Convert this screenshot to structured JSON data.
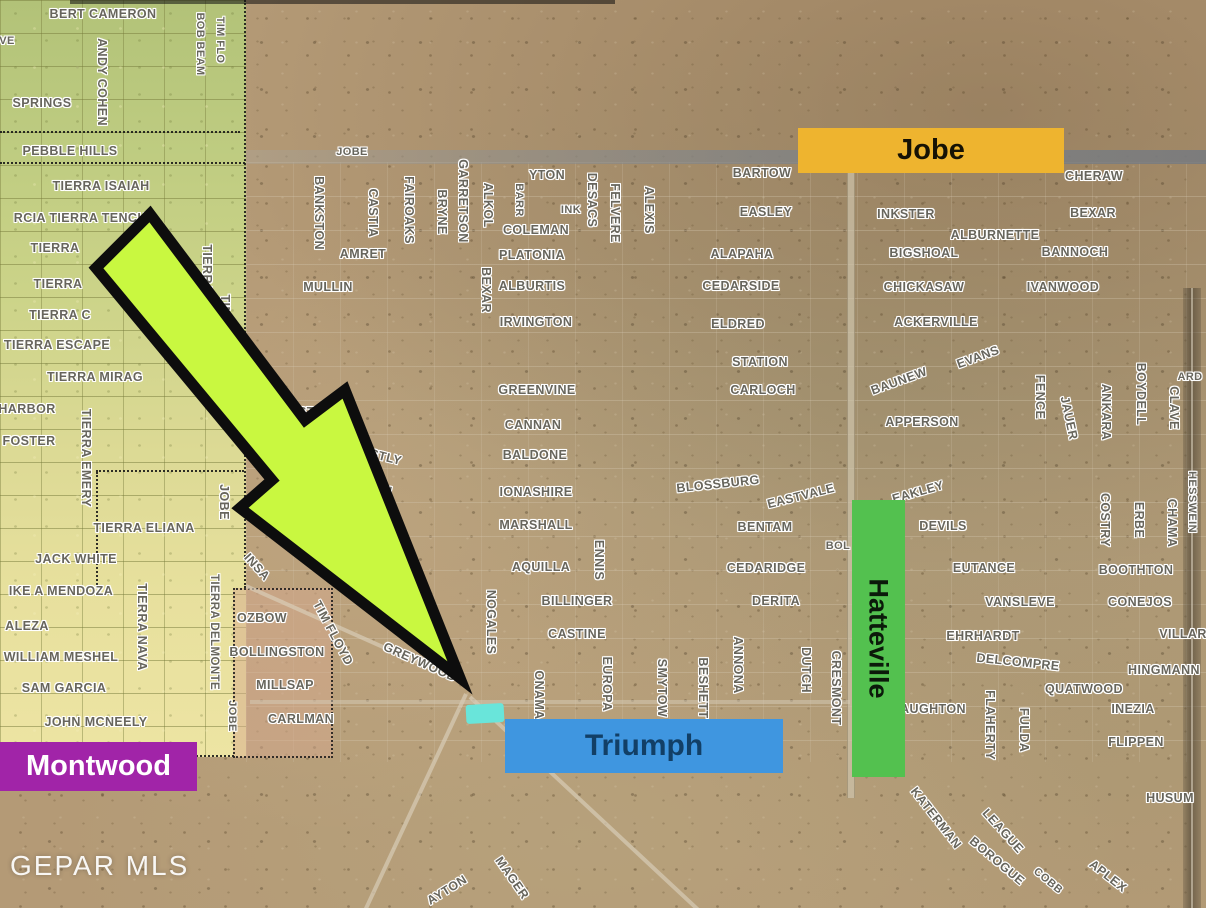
{
  "watermark": {
    "text": "GEPAR MLS"
  },
  "banners": {
    "jobe": {
      "label": "Jobe"
    },
    "triumph": {
      "label": "Triumph"
    },
    "hatteville": {
      "label": "Hatteville"
    },
    "montwood": {
      "label": "Montwood"
    }
  },
  "colors": {
    "jobe_banner": "#eeb42f",
    "triumph_banner": "#3f96e0",
    "hatteville_banner": "#53c14f",
    "montwood_banner": "#a124a8",
    "arrow_fill": "#c9f840",
    "highlight_lot": "#69e5da"
  },
  "street_labels": [
    {
      "t": "BERT CAMERON",
      "x": 103,
      "y": 14
    },
    {
      "t": "VE",
      "x": 7,
      "y": 41,
      "fs": 11
    },
    {
      "t": "ANDY COHEN",
      "x": 102,
      "y": 82,
      "r": 90
    },
    {
      "t": "BOB BEAM",
      "x": 200,
      "y": 44,
      "r": 90,
      "fs": 11
    },
    {
      "t": "TIM FLO",
      "x": 220,
      "y": 40,
      "r": 90,
      "fs": 11
    },
    {
      "t": "SPRINGS",
      "x": 42,
      "y": 103
    },
    {
      "t": "PEBBLE HILLS",
      "x": 70,
      "y": 151
    },
    {
      "t": "TIERRA ISAIAH",
      "x": 101,
      "y": 186
    },
    {
      "t": "RCIA TIERRA TENCHA",
      "x": 85,
      "y": 218
    },
    {
      "t": "TIERRA",
      "x": 55,
      "y": 248
    },
    {
      "t": "EN",
      "x": 148,
      "y": 249,
      "fs": 11
    },
    {
      "t": "TIERRA",
      "x": 58,
      "y": 284
    },
    {
      "t": "TIERRA C",
      "x": 60,
      "y": 315
    },
    {
      "t": "TIERRA ESCAPE",
      "x": 57,
      "y": 345
    },
    {
      "t": "TIERRA MIRAG",
      "x": 95,
      "y": 377
    },
    {
      "t": "HARBOR",
      "x": 27,
      "y": 409
    },
    {
      "t": "FOSTER",
      "x": 29,
      "y": 441
    },
    {
      "t": "TIERRA EMERY",
      "x": 86,
      "y": 458,
      "r": 90
    },
    {
      "t": "TIERRA OASIS",
      "x": 207,
      "y": 291,
      "r": 90
    },
    {
      "t": "TIM FLOYD",
      "x": 225,
      "y": 330,
      "r": 90
    },
    {
      "t": "JOBE",
      "x": 224,
      "y": 502,
      "r": 90
    },
    {
      "t": "TIERRA ELIANA",
      "x": 144,
      "y": 528
    },
    {
      "t": "JACK WHITE",
      "x": 76,
      "y": 559
    },
    {
      "t": "IKE A MENDOZA",
      "x": 61,
      "y": 591
    },
    {
      "t": "ALEZA",
      "x": 27,
      "y": 626
    },
    {
      "t": "WILLIAM MESHEL",
      "x": 61,
      "y": 657
    },
    {
      "t": "SAM GARCIA",
      "x": 64,
      "y": 688
    },
    {
      "t": "JOHN MCNEELY",
      "x": 96,
      "y": 722
    },
    {
      "t": "TIERRA NAVA",
      "x": 142,
      "y": 627,
      "r": 90
    },
    {
      "t": "TIERRA DELMONTE",
      "x": 214,
      "y": 632,
      "r": 90,
      "fs": 11.5
    },
    {
      "t": "JOBE",
      "x": 232,
      "y": 716,
      "r": 90,
      "fs": 11
    },
    {
      "t": "JOBE",
      "x": 352,
      "y": 152,
      "fs": 11
    },
    {
      "t": "BANKSTON",
      "x": 319,
      "y": 213,
      "r": 90
    },
    {
      "t": "CASTIA",
      "x": 373,
      "y": 213,
      "r": 90
    },
    {
      "t": "AMRET",
      "x": 363,
      "y": 254
    },
    {
      "t": "FAIROAKS",
      "x": 409,
      "y": 210,
      "r": 90
    },
    {
      "t": "BRYNE",
      "x": 442,
      "y": 212,
      "r": 90
    },
    {
      "t": "GARRETSON",
      "x": 463,
      "y": 201,
      "r": 90
    },
    {
      "t": "ALKOL",
      "x": 488,
      "y": 205,
      "r": 90
    },
    {
      "t": "YTON",
      "x": 547,
      "y": 175
    },
    {
      "t": "BARR",
      "x": 519,
      "y": 200,
      "r": 90,
      "fs": 11
    },
    {
      "t": "INK",
      "x": 571,
      "y": 210,
      "fs": 11
    },
    {
      "t": "COLEMAN",
      "x": 536,
      "y": 230
    },
    {
      "t": "DESACS",
      "x": 592,
      "y": 200,
      "r": 90
    },
    {
      "t": "FELVERE",
      "x": 615,
      "y": 213,
      "r": 90
    },
    {
      "t": "ALEXIS",
      "x": 649,
      "y": 210,
      "r": 90
    },
    {
      "t": "PLATONIA",
      "x": 532,
      "y": 255
    },
    {
      "t": "BEXAR",
      "x": 486,
      "y": 290,
      "r": 90
    },
    {
      "t": "ALBURTIS",
      "x": 532,
      "y": 286
    },
    {
      "t": "MULLIN",
      "x": 328,
      "y": 287
    },
    {
      "t": "IRVINGTON",
      "x": 536,
      "y": 322
    },
    {
      "t": "BARTOW",
      "x": 762,
      "y": 173
    },
    {
      "t": "EASLEY",
      "x": 766,
      "y": 212
    },
    {
      "t": "INKSTER",
      "x": 906,
      "y": 214
    },
    {
      "t": "ALBURNETTE",
      "x": 995,
      "y": 235
    },
    {
      "t": "ALAPAHA",
      "x": 742,
      "y": 254
    },
    {
      "t": "BIGSHOAL",
      "x": 924,
      "y": 253
    },
    {
      "t": "BANNOCH",
      "x": 1075,
      "y": 252
    },
    {
      "t": "CEDARSIDE",
      "x": 741,
      "y": 286
    },
    {
      "t": "CHICKASAW",
      "x": 924,
      "y": 287
    },
    {
      "t": "IVANWOOD",
      "x": 1063,
      "y": 287
    },
    {
      "t": "CHERAW",
      "x": 1094,
      "y": 176
    },
    {
      "t": "BEXAR",
      "x": 1093,
      "y": 213
    },
    {
      "t": "ACKERVILLE",
      "x": 936,
      "y": 322
    },
    {
      "t": "ELDRED",
      "x": 738,
      "y": 324
    },
    {
      "t": "STATION",
      "x": 760,
      "y": 362
    },
    {
      "t": "CARLOCH",
      "x": 763,
      "y": 390
    },
    {
      "t": "EVANS",
      "x": 978,
      "y": 357,
      "r": -20
    },
    {
      "t": "BAUNEW",
      "x": 899,
      "y": 381,
      "r": -20
    },
    {
      "t": "APPERSON",
      "x": 922,
      "y": 422
    },
    {
      "t": "FENCE",
      "x": 1040,
      "y": 397,
      "r": 90
    },
    {
      "t": "JAUER",
      "x": 1069,
      "y": 418,
      "r": 78
    },
    {
      "t": "ANKARA",
      "x": 1106,
      "y": 412,
      "r": 90
    },
    {
      "t": "BOYDELL",
      "x": 1141,
      "y": 394,
      "r": 90
    },
    {
      "t": "CLAVE",
      "x": 1174,
      "y": 408,
      "r": 90
    },
    {
      "t": "ARD",
      "x": 1190,
      "y": 377,
      "fs": 11
    },
    {
      "t": "GREENVINE",
      "x": 537,
      "y": 390
    },
    {
      "t": "CANNAN",
      "x": 533,
      "y": 425
    },
    {
      "t": "BALDONE",
      "x": 535,
      "y": 455
    },
    {
      "t": "IONASHIRE",
      "x": 536,
      "y": 492
    },
    {
      "t": "MARSHALL",
      "x": 536,
      "y": 525
    },
    {
      "t": "ANNISTON",
      "x": 300,
      "y": 412
    },
    {
      "t": "EASTLY",
      "x": 377,
      "y": 455,
      "r": 14
    },
    {
      "t": "AMAN",
      "x": 373,
      "y": 487,
      "r": 14
    },
    {
      "t": "BLOSSBURG",
      "x": 718,
      "y": 484,
      "r": -6
    },
    {
      "t": "EASTVALE",
      "x": 801,
      "y": 496,
      "r": -14
    },
    {
      "t": "EAKLEY",
      "x": 918,
      "y": 492,
      "r": -16
    },
    {
      "t": "BENTAM",
      "x": 765,
      "y": 527
    },
    {
      "t": "DEVILS",
      "x": 943,
      "y": 526
    },
    {
      "t": "BOL",
      "x": 838,
      "y": 546,
      "fs": 11
    },
    {
      "t": "CEDARIDGE",
      "x": 766,
      "y": 568
    },
    {
      "t": "EUTANCE",
      "x": 984,
      "y": 568
    },
    {
      "t": "BOOTHTON",
      "x": 1136,
      "y": 570
    },
    {
      "t": "VANSLEVE",
      "x": 1020,
      "y": 602
    },
    {
      "t": "CONEJOS",
      "x": 1140,
      "y": 602
    },
    {
      "t": "DERITA",
      "x": 776,
      "y": 601
    },
    {
      "t": "EHRHARDT",
      "x": 983,
      "y": 636
    },
    {
      "t": "VILLAR",
      "x": 1183,
      "y": 634
    },
    {
      "t": "DELCOMPRE",
      "x": 1018,
      "y": 662,
      "r": 6
    },
    {
      "t": "HINGMANN",
      "x": 1164,
      "y": 670
    },
    {
      "t": "QUATWOOD",
      "x": 1084,
      "y": 689
    },
    {
      "t": "INEZIA",
      "x": 1133,
      "y": 709
    },
    {
      "t": "AUGHTON",
      "x": 933,
      "y": 709
    },
    {
      "t": "FLIPPEN",
      "x": 1136,
      "y": 742
    },
    {
      "t": "FLAHERTY",
      "x": 990,
      "y": 725,
      "r": 90
    },
    {
      "t": "FULDA",
      "x": 1024,
      "y": 730,
      "r": 90
    },
    {
      "t": "CRESMONT",
      "x": 836,
      "y": 688,
      "r": 90
    },
    {
      "t": "ENNIS",
      "x": 599,
      "y": 560,
      "r": 90
    },
    {
      "t": "AQUILLA",
      "x": 541,
      "y": 567
    },
    {
      "t": "BILLINGER",
      "x": 577,
      "y": 601
    },
    {
      "t": "CASTINE",
      "x": 577,
      "y": 634
    },
    {
      "t": "NOGALES",
      "x": 491,
      "y": 622,
      "r": 90
    },
    {
      "t": "EUROPA",
      "x": 607,
      "y": 684,
      "r": 90
    },
    {
      "t": "SMYTOW",
      "x": 662,
      "y": 688,
      "r": 90
    },
    {
      "t": "BESHETT",
      "x": 703,
      "y": 688,
      "r": 90
    },
    {
      "t": "ANNONA",
      "x": 738,
      "y": 665,
      "r": 90
    },
    {
      "t": "DUTCH",
      "x": 806,
      "y": 670,
      "r": 90
    },
    {
      "t": "ONAMA",
      "x": 539,
      "y": 695,
      "r": 90
    },
    {
      "t": "GREYWOOD",
      "x": 420,
      "y": 662,
      "r": 24
    },
    {
      "t": "TIM FLOYD",
      "x": 333,
      "y": 633,
      "r": 62
    },
    {
      "t": "INSA",
      "x": 257,
      "y": 567,
      "r": 48
    },
    {
      "t": "OZBOW",
      "x": 262,
      "y": 618
    },
    {
      "t": "BOLLINGSTON",
      "x": 277,
      "y": 652
    },
    {
      "t": "MILLSAP",
      "x": 285,
      "y": 685
    },
    {
      "t": "CARLMAN",
      "x": 301,
      "y": 719
    },
    {
      "t": "KATERMAN",
      "x": 936,
      "y": 818,
      "r": 52
    },
    {
      "t": "LEAGUE",
      "x": 1003,
      "y": 831,
      "r": 48
    },
    {
      "t": "BOROGUE",
      "x": 997,
      "y": 861,
      "r": 40
    },
    {
      "t": "COBB",
      "x": 1048,
      "y": 881,
      "r": 40,
      "fs": 11
    },
    {
      "t": "APLEX",
      "x": 1108,
      "y": 876,
      "r": 38
    },
    {
      "t": "HUSUM",
      "x": 1170,
      "y": 798
    },
    {
      "t": "HESSWEIN",
      "x": 1192,
      "y": 502,
      "r": 90,
      "fs": 11
    },
    {
      "t": "COSTRY",
      "x": 1105,
      "y": 520,
      "r": 90
    },
    {
      "t": "ERBE",
      "x": 1139,
      "y": 520,
      "r": 90
    },
    {
      "t": "CHAMA",
      "x": 1172,
      "y": 523,
      "r": 90
    },
    {
      "t": "AYTON",
      "x": 447,
      "y": 890,
      "r": -32
    },
    {
      "t": "MAGER",
      "x": 512,
      "y": 878,
      "r": 55
    }
  ]
}
